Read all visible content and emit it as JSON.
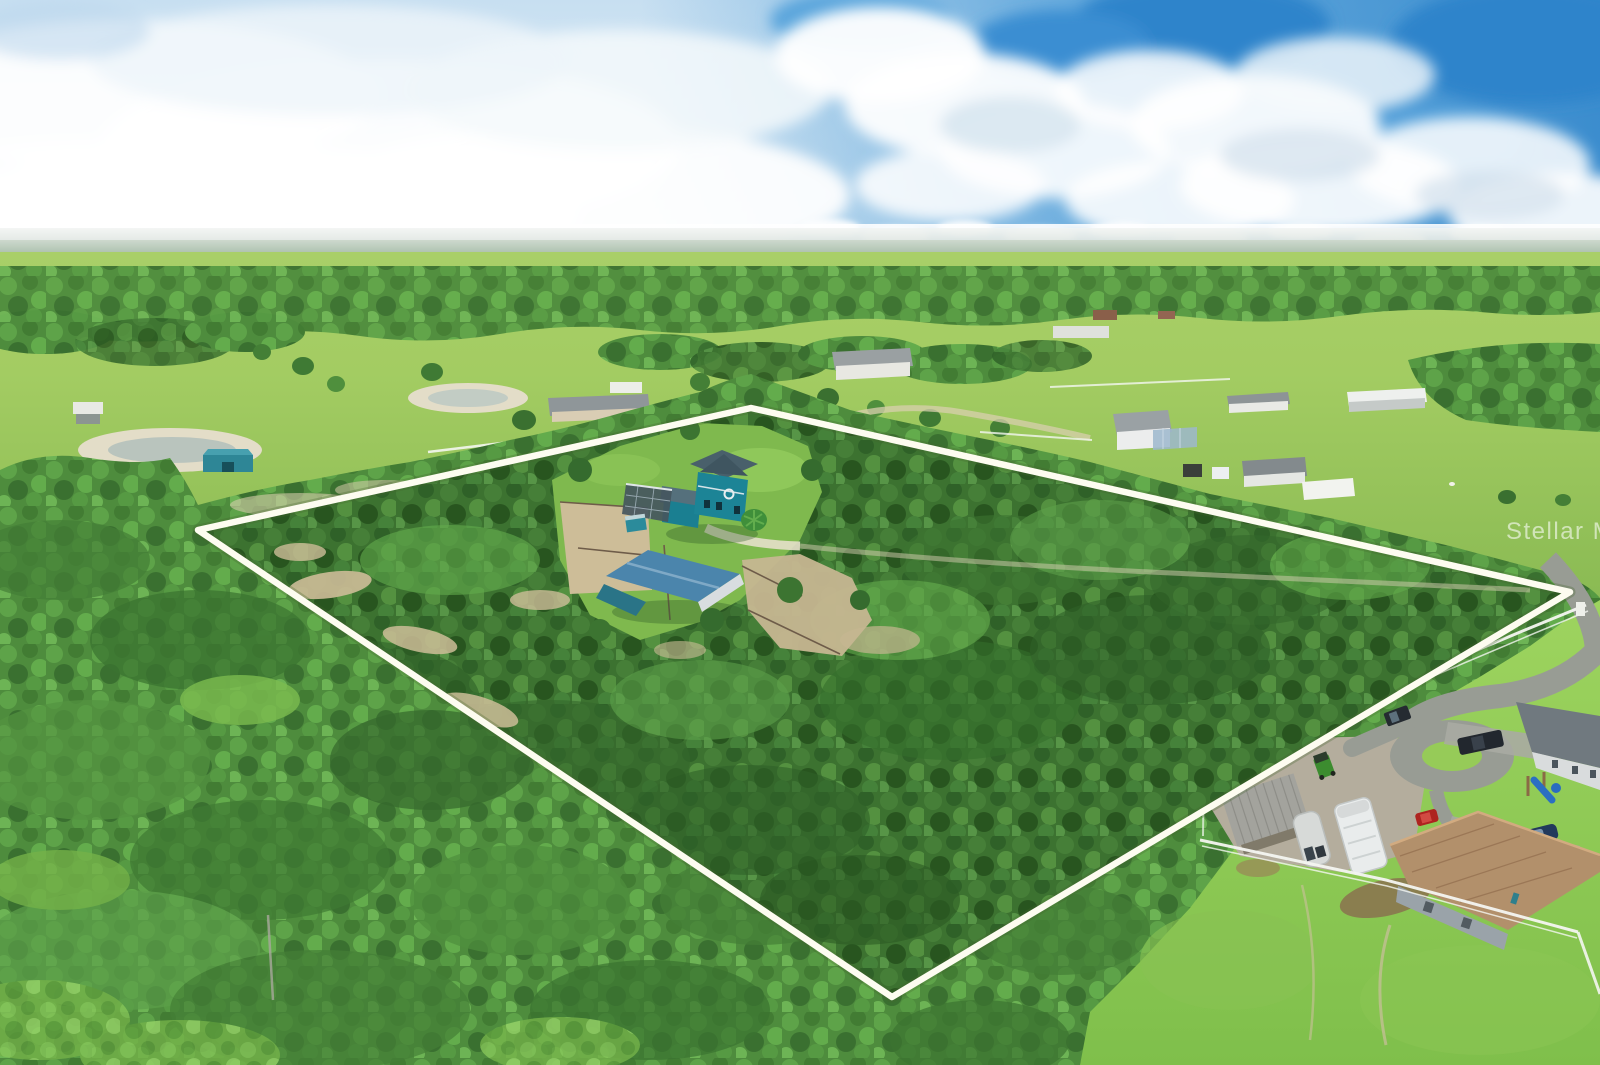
{
  "watermark": {
    "text": "Stellar MLS"
  },
  "scene": {
    "description": "Aerial drone photo of a large wooded acreage parcel outlined in white, containing a teal two-story house with screened pool enclosure, a blue barn and sandy horse paddocks; surrounded by green pastures, scattered rural homes, a distant lake under a cumulus sky, and a neighboring home at lower right with carport, RVs, vehicles and a cul-de-sac street",
    "elements": [
      "sky-cumulus-clouds",
      "distant-lake",
      "distant-treeline",
      "pastures",
      "rural-houses",
      "ponds",
      "property-boundary-outline",
      "teal-house",
      "screened-pool-enclosure",
      "blue-barn",
      "horse-paddock",
      "pine-forest",
      "sand-trails",
      "driveway",
      "street-and-cul-de-sac",
      "white-rail-fences",
      "carport",
      "rv-trailers",
      "green-tractor",
      "pickup-trucks",
      "red-car",
      "blue-car",
      "playground",
      "tan-tile-roof-house",
      "gray-roof-house"
    ]
  },
  "colors": {
    "boundary_white": "#fdfcf0",
    "sky_blue": "#4598d6",
    "sky_deep_blue": "#3388cc",
    "cloud_white": "#ffffff",
    "haze_white": "#eef4f8",
    "water_blue": "#8fb3c9",
    "field_green": "#9ac75e",
    "forest_green": "#4e8c3d",
    "forest_dark": "#3c7230",
    "lawn_lime": "#97cf5b",
    "sand_tan": "#cdbd98",
    "house_teal": "#1c8496",
    "house_roof_slate": "#49606b",
    "pool_cage_gray": "#45565e",
    "barn_roof_blue": "#4b85ac",
    "road_gray": "#989c94",
    "gravel_gray": "#b4ad9d",
    "tile_roof_tan": "#b2906b",
    "fence_white": "#f4f6f1",
    "rv_white": "#e9ecec"
  }
}
